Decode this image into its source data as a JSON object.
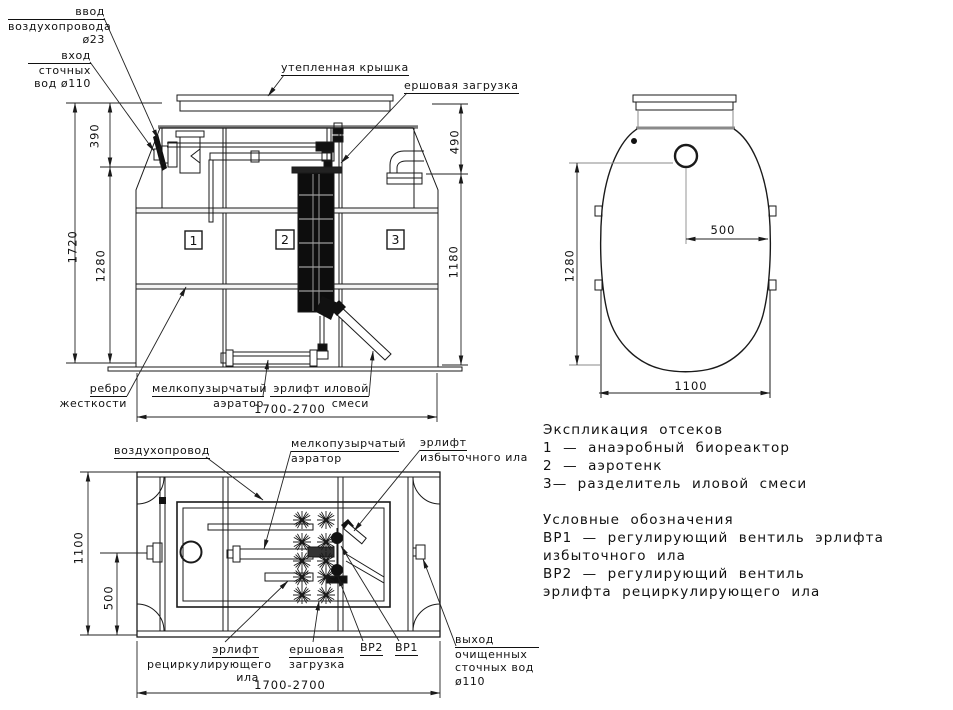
{
  "drawing": {
    "colors": {
      "line": "#1a1a1a",
      "construction": "#8a8a8a",
      "background": "#ffffff"
    },
    "front_view": {
      "callouts": {
        "air_inlet": [
          "ввод",
          "воздухопровода",
          "ø23"
        ],
        "sewage_inlet": [
          "вход",
          "сточных",
          "вод ø110"
        ],
        "insulated_cover": "утепленная крышка",
        "brush_media": "ершовая загрузка",
        "stiffening_rib": [
          "ребро",
          "жесткости"
        ],
        "aerator": [
          "мелкопузырчатый",
          "аэратор"
        ],
        "sludge_airlift": [
          "эрлифт иловой",
          "смеси"
        ]
      },
      "compartment_numbers": [
        "1",
        "2",
        "3"
      ],
      "dimensions": {
        "inlet_depth": "390",
        "total_height": "1720",
        "body_height_left": "1280",
        "top_height_right": "490",
        "body_height_right": "1180",
        "length": "1700-2700"
      }
    },
    "side_view": {
      "dimensions": {
        "port_offset": "500",
        "height": "1280",
        "width": "1100"
      }
    },
    "plan_view": {
      "callouts": {
        "air_line": "воздухопровод",
        "aerator": [
          "мелкопузырчатый",
          "аэратор"
        ],
        "excess_sludge_airlift": [
          "эрлифт",
          "избыточного ила"
        ],
        "recirc_sludge_airlift": [
          "эрлифт",
          "рециркулирующего",
          "ила"
        ],
        "brush_media": [
          "ершовая",
          "загрузка"
        ],
        "valve2": "ВР2",
        "valve1": "ВР1",
        "outlet": [
          "выход",
          "очищенных",
          "сточных вод",
          "ø110"
        ]
      },
      "dimensions": {
        "width": "1100",
        "port_offset": "500",
        "length": "1700-2700"
      }
    },
    "legend": {
      "compartments_title": "Экспликация отсеков",
      "compartments": [
        "1 — анаэробный биореактор",
        "2 — аэротенк",
        "3— разделитель иловой смеси"
      ],
      "symbols_title": "Условные обозначения",
      "symbols": [
        "ВР1 — регулирующий вентиль эрлифта",
        "избыточного ила",
        "ВР2 — регулирующий вентиль",
        "эрлифта рециркулирующего ила"
      ]
    }
  }
}
